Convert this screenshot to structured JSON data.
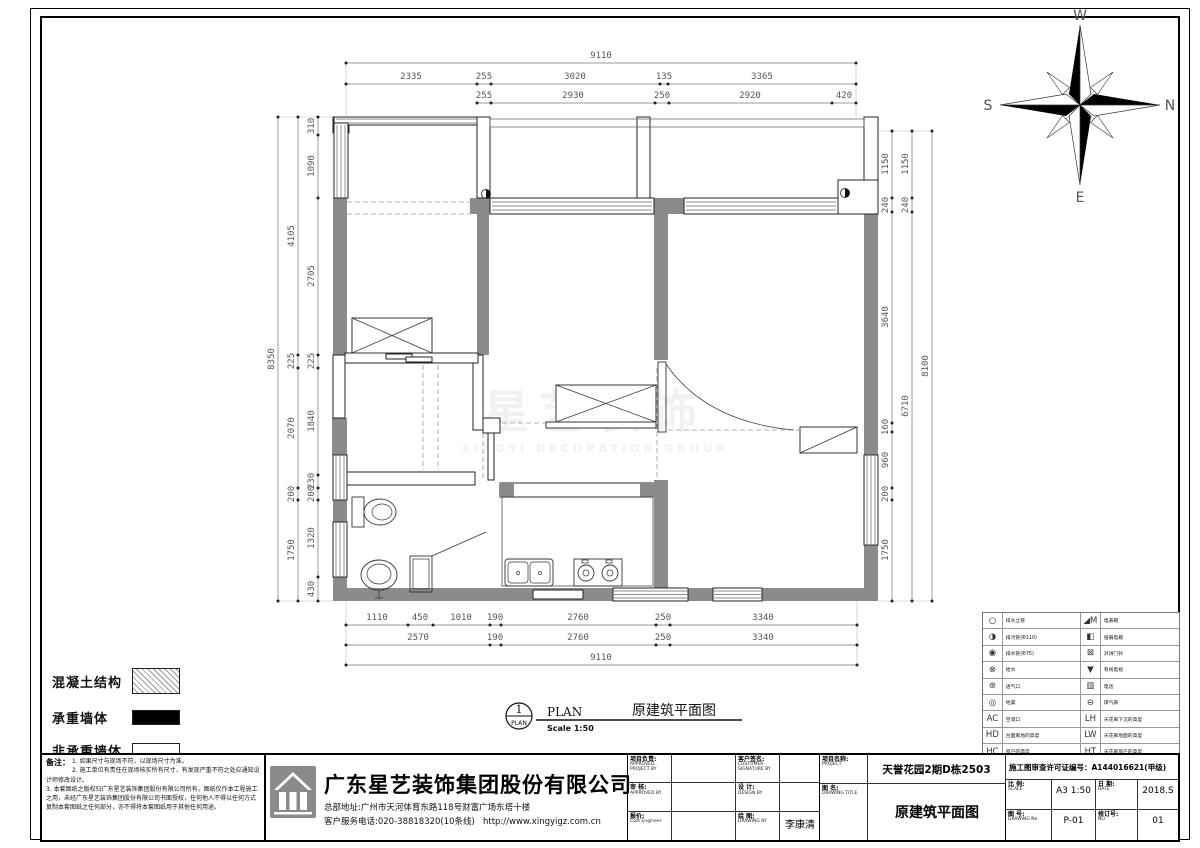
{
  "compass": {
    "n": "N",
    "s": "S",
    "e": "E",
    "w": "W"
  },
  "dims": {
    "top": {
      "row1": "9110",
      "row2": [
        "2335",
        "255",
        "3020",
        "135",
        "3365"
      ],
      "row3": [
        "255",
        "2930",
        "250",
        "2920",
        "420"
      ]
    },
    "left": {
      "outer": "8350",
      "mid": [
        "4105",
        "225",
        "2070",
        "200",
        "1750"
      ],
      "inner": [
        "310",
        "1090",
        "2705",
        "225",
        "1840",
        "230",
        "200",
        "1320",
        "430"
      ]
    },
    "right": {
      "outer": "8100",
      "mid": [
        "1150",
        "240",
        "6710"
      ],
      "inner": [
        "1150",
        "240",
        "3640",
        "160",
        "960",
        "200",
        "1750"
      ]
    },
    "bottom": {
      "row1": [
        "1110",
        "450",
        "1010",
        "190",
        "2760",
        "250",
        "3340"
      ],
      "row2": [
        "2570",
        "190",
        "2760",
        "250",
        "3340"
      ],
      "row3": "9110"
    }
  },
  "plan_callout": {
    "number": "1",
    "tag": "PLAN",
    "label": "PLAN",
    "scale": "Scale 1:50",
    "title": "原建筑平面图"
  },
  "watermark": {
    "line1": "星艺装饰",
    "line2": "XINGYI DECORATION GROUP"
  },
  "legend": {
    "items": [
      {
        "label": "混凝土结构",
        "swatch": "hatch"
      },
      {
        "label": "承重墙体",
        "swatch": "black"
      },
      {
        "label": "非承重墙体",
        "swatch": "white"
      }
    ]
  },
  "notes": {
    "heading": "备注：",
    "lines": [
      "1. 如果尺寸与现场不符，以现场尺寸为准。",
      "2. 施工单位有责任在现场核实所有尺寸，有发现严重不符之处应通知设计师修改设计。",
      "3. 本套图纸之版权归广东星艺装饰集团股份有限公司所有，图纸仅作本工程施工之用，未经广东星艺装饰集团股份有限公司书面授权，任何他人不得以任何方式复制本套图纸之任何部分，亦不得将本套图纸用于其他任何用途。"
    ]
  },
  "title_block": {
    "company": "广东星艺装饰集团股份有限公司",
    "address": "总部地址:广州市天河体育东路118号财富广场东塔十楼",
    "phone": "客户服务电话:020-38818320(10条线)",
    "website": "http://www.xingyigz.com.cn",
    "fields": [
      {
        "label": "项目负责:",
        "sub": "APPROVED PROJECT BY",
        "value": ""
      },
      {
        "label": "客户签名:",
        "sub": "CUSTOMER SIGNATURE BY",
        "value": ""
      },
      {
        "label": "审 核:",
        "sub": "APPROVED BY",
        "value": ""
      },
      {
        "label": "设 计:",
        "sub": "DESIGN BY",
        "value": ""
      },
      {
        "label": "报价:",
        "sub": "Cost Engineer",
        "value": ""
      },
      {
        "label": "绘 图:",
        "sub": "DRAWING BY",
        "value": "李康清"
      }
    ],
    "project": {
      "label": "项目名称:",
      "sub": "PROJECT",
      "value": "天誉花园2期D栋2503"
    },
    "drawing": {
      "label": "图 名:",
      "sub": "DRAWING TITLE",
      "value": "原建筑平面图"
    },
    "license": "施工图审查许可证编号：A144016621(甲级)",
    "scale": {
      "label": "比 例:",
      "sub": "SCALE",
      "value": "A3 1:50"
    },
    "date": {
      "label": "日 期:",
      "sub": "DATE",
      "value": "2018.S"
    },
    "drawing_no": {
      "label": "图 号:",
      "sub": "DRAWING No",
      "value": "P-01"
    },
    "rev_no": {
      "label": "修订号:",
      "sub": "NO.",
      "value": "01"
    }
  },
  "legend_table": {
    "left": [
      {
        "icon": "drain-riser-icon",
        "glyph": "○",
        "label": "排水立管"
      },
      {
        "icon": "sewage-pipe-icon",
        "glyph": "◑",
        "label": "排污管(Φ110)"
      },
      {
        "icon": "drain-pipe-icon",
        "glyph": "◉",
        "label": "排水管(Φ75)"
      },
      {
        "icon": "water-supply-icon",
        "glyph": "⊗",
        "label": "给水"
      },
      {
        "icon": "vent-icon",
        "glyph": "⊛",
        "label": "透气口"
      },
      {
        "icon": "floor-drain-icon",
        "glyph": "◎",
        "label": "地漏"
      },
      {
        "icon": "ac-outlet-icon",
        "glyph": "AC",
        "label": "空调口"
      },
      {
        "icon": "counter-height-icon",
        "glyph": "HD",
        "label": "台面离地的高度"
      },
      {
        "icon": "window-height-icon",
        "glyph": "HC",
        "label": "窗户的高度"
      }
    ],
    "right": [
      {
        "icon": "meter-box-icon",
        "glyph": "◢M",
        "label": "电表箱"
      },
      {
        "icon": "power-box-icon",
        "glyph": "◧",
        "label": "强弱电箱"
      },
      {
        "icon": "intercom-doorbell-icon",
        "glyph": "⊠",
        "label": "对讲门铃"
      },
      {
        "icon": "cable-tv-icon",
        "glyph": "▼",
        "label": "有线电视"
      },
      {
        "icon": "phone-icon",
        "glyph": "▥",
        "label": "电话"
      },
      {
        "icon": "gas-meter-icon",
        "glyph": "⊖",
        "label": "煤气表"
      },
      {
        "icon": "ceiling-drop-height-icon",
        "glyph": "LH",
        "label": "天花离下沉的高度"
      },
      {
        "icon": "ceiling-floor-height-icon",
        "glyph": "LW",
        "label": "天花离地面的高度"
      },
      {
        "icon": "ceiling-window-height-icon",
        "glyph": "HT",
        "label": "天花离窗户的高度"
      }
    ]
  }
}
